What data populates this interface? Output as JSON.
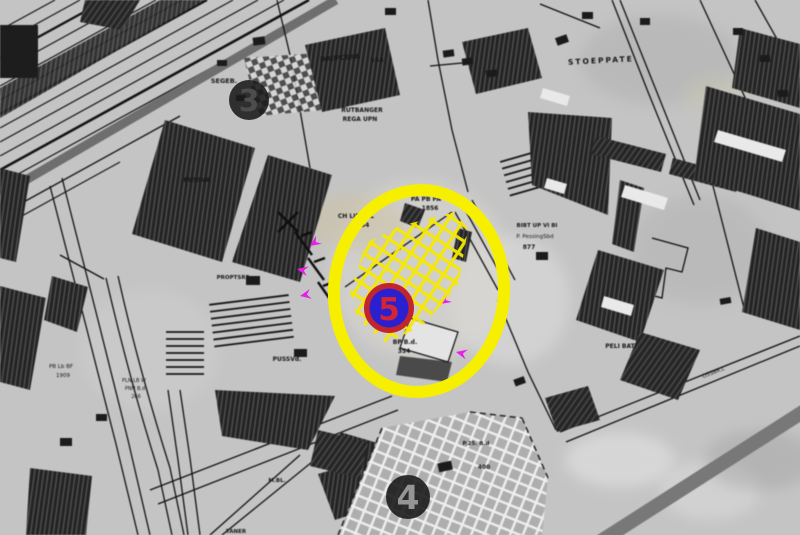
{
  "map": {
    "background_color": "#c4c4c4",
    "street_label": "STOEPPATE",
    "labels": [
      {
        "text": "SEGEB.",
        "x": 224,
        "y": 83,
        "s": 6.5,
        "b": 1
      },
      {
        "text": "DRUPCERA",
        "x": 340,
        "y": 60,
        "s": 6.5,
        "b": 1,
        "r": -4
      },
      {
        "text": "554",
        "x": 377,
        "y": 62,
        "s": 6.5,
        "b": 1
      },
      {
        "text": "RUTBANGER",
        "x": 362,
        "y": 112,
        "s": 6,
        "b": 1
      },
      {
        "text": "REGA UPN",
        "x": 360,
        "y": 121,
        "s": 6,
        "b": 1
      },
      {
        "text": "PA PB PA",
        "x": 426,
        "y": 201,
        "s": 6,
        "b": 1
      },
      {
        "text": "1856",
        "x": 430,
        "y": 210,
        "s": 6,
        "b": 1
      },
      {
        "text": "CH LIP PAL",
        "x": 356,
        "y": 218,
        "s": 6,
        "b": 1
      },
      {
        "text": "354",
        "x": 363,
        "y": 227,
        "s": 6,
        "b": 1
      },
      {
        "text": "STOEPPATE",
        "x": 601,
        "y": 63,
        "s": 7.5,
        "b": 1,
        "r": -3,
        "ls": 2
      },
      {
        "text": "BIBT UP VI BI",
        "x": 537,
        "y": 227,
        "s": 5.5,
        "b": 1
      },
      {
        "text": "P. PessingSbd",
        "x": 535,
        "y": 238,
        "s": 5.5
      },
      {
        "text": "877",
        "x": 529,
        "y": 249,
        "s": 6,
        "b": 1
      },
      {
        "text": "PUSSVA",
        "x": 197,
        "y": 182,
        "s": 6,
        "b": 1
      },
      {
        "text": "PROPTSRE",
        "x": 233,
        "y": 279,
        "s": 5.5,
        "b": 1
      },
      {
        "text": "BP B.d.",
        "x": 405,
        "y": 344,
        "s": 6,
        "b": 1
      },
      {
        "text": "354",
        "x": 404,
        "y": 353,
        "s": 6,
        "b": 1
      },
      {
        "text": "PUSSVd.",
        "x": 287,
        "y": 361,
        "s": 6,
        "b": 1
      },
      {
        "text": "PLN LB W",
        "x": 134,
        "y": 382,
        "s": 5
      },
      {
        "text": "PNN B.d",
        "x": 135,
        "y": 390,
        "s": 5
      },
      {
        "text": "266",
        "x": 136,
        "y": 398,
        "s": 5
      },
      {
        "text": "PB Lb BF",
        "x": 61,
        "y": 368,
        "s": 5.5
      },
      {
        "text": "1909",
        "x": 63,
        "y": 377,
        "s": 5.5
      },
      {
        "text": "PELI BAT",
        "x": 620,
        "y": 348,
        "s": 6,
        "b": 1
      },
      {
        "text": "M.BL.",
        "x": 277,
        "y": 482,
        "s": 5.5,
        "b": 1
      },
      {
        "text": "P.25. B.d",
        "x": 476,
        "y": 445,
        "s": 5.5,
        "b": 1
      },
      {
        "text": "400",
        "x": 484,
        "y": 469,
        "s": 6,
        "b": 1
      },
      {
        "text": "TANER",
        "x": 236,
        "y": 533,
        "s": 5.5,
        "b": 1
      },
      {
        "text": "OSSBR.L",
        "x": 714,
        "y": 374,
        "s": 5.5,
        "r": -21
      }
    ]
  },
  "annotations": {
    "highlight": {
      "ellipse_color": "#f7ef00",
      "hatch_color": "#f5e900"
    },
    "site_marker": {
      "number": "5",
      "circle_color": "#2a20cf",
      "ring_color": "#c2252d",
      "number_color": "#d42535"
    },
    "area_marker_3": {
      "number": "3",
      "fill": "#1a1a1a",
      "number_color": "#4e4e4e"
    },
    "area_marker_4": {
      "number": "4",
      "fill": "#1c1c1c",
      "number_color": "#9a9a9a"
    },
    "survey_markers": {
      "color": "#e81ee8",
      "points": [
        [
          310,
          246
        ],
        [
          297,
          269
        ],
        [
          300,
          296
        ],
        [
          440,
          304
        ],
        [
          456,
          352
        ]
      ]
    }
  }
}
